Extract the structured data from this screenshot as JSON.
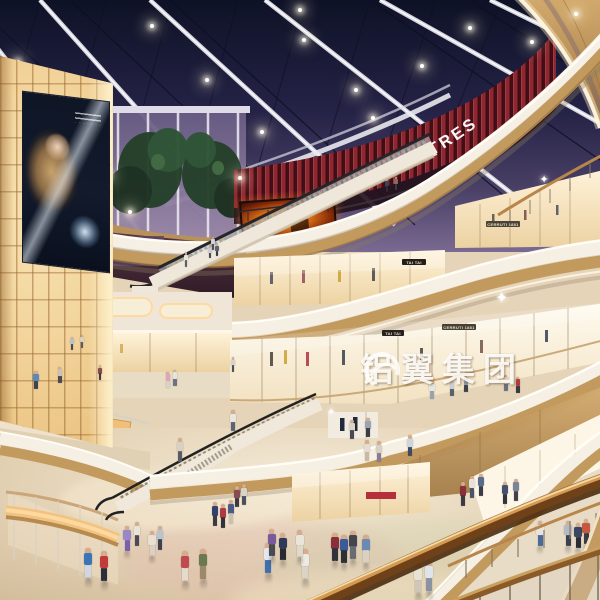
{
  "scene_label": "shopping mall atrium interior rendering",
  "signs": {
    "theatre": {
      "label": "THEATRES"
    },
    "watermark": {
      "label": "铝翼集团"
    },
    "shops": [
      {
        "label": "CERRUTI 1881"
      },
      {
        "label": "TAI TAI"
      },
      {
        "label": "TAI TAI"
      },
      {
        "label": "CERRUTI 1881"
      }
    ]
  },
  "colors": {
    "sky_top": "#0e1226",
    "sky_bottom": "#7a6a92",
    "slat_red": "#b93340",
    "slat_dark": "#4a0f16",
    "amber_wall": "#f3d59d",
    "wood": "#c29a5e",
    "cream_fascia": "#f5efe4",
    "floor": "#e2d0b2",
    "handrail_wood": "#6e4119",
    "fire_billboard": "#f08018"
  },
  "lamps": [
    [
      18,
      62
    ],
    [
      64,
      120
    ],
    [
      108,
      176
    ],
    [
      152,
      26
    ],
    [
      207,
      80
    ],
    [
      262,
      132
    ],
    [
      304,
      40
    ],
    [
      356,
      90
    ],
    [
      300,
      10
    ],
    [
      422,
      66
    ],
    [
      470,
      28
    ],
    [
      532,
      42
    ],
    [
      576,
      14
    ],
    [
      240,
      178
    ],
    [
      130,
      212
    ],
    [
      373,
      118
    ]
  ],
  "sparkles": [
    {
      "x": 503,
      "y": 296,
      "size": 16
    },
    {
      "x": 545,
      "y": 178,
      "size": 11
    },
    {
      "x": 332,
      "y": 412,
      "size": 10
    }
  ],
  "people": [
    {
      "x": 88,
      "y": 578,
      "s": 1,
      "t": "#3a76b5",
      "b": "#cfd8e2"
    },
    {
      "x": 104,
      "y": 581,
      "s": 1,
      "t": "#c23b3b",
      "b": "#2e2e38"
    },
    {
      "x": 127,
      "y": 551,
      "s": 0.85,
      "t": "#9a86c9",
      "b": "#7a5fae"
    },
    {
      "x": 137,
      "y": 546,
      "s": 0.8,
      "t": "#e8e4da",
      "b": "#4a4a52"
    },
    {
      "x": 152,
      "y": 556,
      "s": 0.85,
      "t": "#e8e0d2",
      "b": "#d9d2c4"
    },
    {
      "x": 160,
      "y": 550,
      "s": 0.8,
      "t": "#b8c4d4",
      "b": "#3c4250"
    },
    {
      "x": 185,
      "y": 581,
      "s": 1,
      "t": "#c14a50",
      "b": "#e3dccc"
    },
    {
      "x": 203,
      "y": 579,
      "s": 1,
      "t": "#6a7a4e",
      "b": "#9a8a6a"
    },
    {
      "x": 215,
      "y": 526,
      "s": 0.8,
      "t": "#32406e",
      "b": "#3a3a42"
    },
    {
      "x": 223,
      "y": 528,
      "s": 0.8,
      "t": "#b03a44",
      "b": "#32323a"
    },
    {
      "x": 231,
      "y": 524,
      "s": 0.8,
      "t": "#4a5a80",
      "b": "#c9c2b2"
    },
    {
      "x": 237,
      "y": 507,
      "s": 0.7,
      "t": "#8a4a52",
      "b": "#3a3a42"
    },
    {
      "x": 244,
      "y": 505,
      "s": 0.7,
      "t": "#d9d4c8",
      "b": "#4a5262"
    },
    {
      "x": 268,
      "y": 573,
      "s": 1,
      "t": "#e4e8ee",
      "b": "#3f6fae"
    },
    {
      "x": 305,
      "y": 579,
      "s": 1,
      "t": "#eceae2",
      "b": "#d9d4c6"
    },
    {
      "x": 272,
      "y": 556,
      "s": 0.9,
      "t": "#7a5a9a",
      "b": "#4a4a52"
    },
    {
      "x": 283,
      "y": 560,
      "s": 0.9,
      "t": "#2e3a5a",
      "b": "#2a2a32"
    },
    {
      "x": 300,
      "y": 557,
      "s": 0.9,
      "t": "#e9e5d9",
      "b": "#e0d9c9"
    },
    {
      "x": 335,
      "y": 561,
      "s": 0.95,
      "t": "#8a2e3a",
      "b": "#32323c"
    },
    {
      "x": 344,
      "y": 563,
      "s": 0.95,
      "t": "#3a5a9a",
      "b": "#2e2e36"
    },
    {
      "x": 353,
      "y": 559,
      "s": 0.95,
      "t": "#44444e",
      "b": "#6a6a74"
    },
    {
      "x": 366,
      "y": 563,
      "s": 0.95,
      "t": "#6a8ab4",
      "b": "#d9d2c2"
    },
    {
      "x": 418,
      "y": 593,
      "s": 1,
      "t": "#e8e2d4",
      "b": "#cfc8b8"
    },
    {
      "x": 429,
      "y": 591,
      "s": 1,
      "t": "#dfe4ea",
      "b": "#8a93a4"
    },
    {
      "x": 463,
      "y": 506,
      "s": 0.8,
      "t": "#8a3038",
      "b": "#3a3a44"
    },
    {
      "x": 472,
      "y": 498,
      "s": 0.75,
      "t": "#e6e2d8",
      "b": "#4a5468"
    },
    {
      "x": 481,
      "y": 496,
      "s": 0.75,
      "t": "#5a6a8a",
      "b": "#3c3c46"
    },
    {
      "x": 540,
      "y": 546,
      "s": 0.85,
      "t": "#e8e4dc",
      "b": "#4a6a9a"
    },
    {
      "x": 568,
      "y": 546,
      "s": 0.85,
      "t": "#b4bac4",
      "b": "#3a4050"
    },
    {
      "x": 578,
      "y": 548,
      "s": 0.85,
      "t": "#3a4662",
      "b": "#2c2c34"
    },
    {
      "x": 586,
      "y": 544,
      "s": 0.85,
      "t": "#c9563e",
      "b": "#3a3a42"
    },
    {
      "x": 505,
      "y": 504,
      "s": 0.75,
      "t": "#44506e",
      "b": "#33333b"
    },
    {
      "x": 516,
      "y": 501,
      "s": 0.75,
      "t": "#7a8498",
      "b": "#42424c"
    },
    {
      "x": 233,
      "y": 431,
      "s": 0.7,
      "t": "#e9e6de",
      "b": "#5a6474"
    },
    {
      "x": 180,
      "y": 462,
      "s": 0.8,
      "t": "#d9d0c2",
      "b": "#5a5a64"
    },
    {
      "x": 352,
      "y": 439,
      "s": 0.65,
      "t": "#d9d4c8",
      "b": "#4a4a54"
    },
    {
      "x": 368,
      "y": 437,
      "s": 0.65,
      "t": "#9aa4b4",
      "b": "#3c3c46"
    },
    {
      "x": 367,
      "y": 461,
      "s": 0.7,
      "t": "#e4ddd0",
      "b": "#c9b8a4"
    },
    {
      "x": 379,
      "y": 462,
      "s": 0.7,
      "t": "#d9cfc2",
      "b": "#8a7a9a"
    },
    {
      "x": 410,
      "y": 456,
      "s": 0.7,
      "t": "#cfd4dc",
      "b": "#3f4a60"
    },
    {
      "x": 432,
      "y": 399,
      "s": 0.6,
      "t": "#e9e6df",
      "b": "#9aa2ae"
    },
    {
      "x": 452,
      "y": 396,
      "s": 0.55,
      "t": "#c9cdd6",
      "b": "#5a5f6c"
    },
    {
      "x": 466,
      "y": 392,
      "s": 0.55,
      "t": "#8a93a2",
      "b": "#3d424e"
    },
    {
      "x": 506,
      "y": 391,
      "s": 0.55,
      "t": "#d9d5cc",
      "b": "#6a7080"
    },
    {
      "x": 518,
      "y": 393,
      "s": 0.55,
      "t": "#b43a42",
      "b": "#3a3a44"
    },
    {
      "x": 36,
      "y": 389,
      "s": 0.6,
      "t": "#5a89b8",
      "b": "#3c4252"
    },
    {
      "x": 60,
      "y": 383,
      "s": 0.55,
      "t": "#c9c2b4",
      "b": "#4a4a54"
    },
    {
      "x": 100,
      "y": 380,
      "s": 0.5,
      "t": "#8a4a4a",
      "b": "#3a3a42"
    },
    {
      "x": 168,
      "y": 388,
      "s": 0.55,
      "t": "#e2a4b8",
      "b": "#d9d2c4"
    },
    {
      "x": 175,
      "y": 386,
      "s": 0.55,
      "t": "#e8e4da",
      "b": "#6a7284"
    },
    {
      "x": 233,
      "y": 372,
      "s": 0.5,
      "t": "#d9d4ca",
      "b": "#4a4f5c"
    },
    {
      "x": 72,
      "y": 350,
      "s": 0.45,
      "t": "#b8c2d0",
      "b": "#4a4a52"
    },
    {
      "x": 82,
      "y": 348,
      "s": 0.45,
      "t": "#d9d0c0",
      "b": "#5a5a64"
    },
    {
      "x": 387,
      "y": 192,
      "s": 0.45,
      "t": "#3a4258",
      "b": "#2c2c34"
    },
    {
      "x": 396,
      "y": 190,
      "s": 0.45,
      "t": "#8a6a5a",
      "b": "#3a3a42"
    },
    {
      "x": 210,
      "y": 258,
      "s": 0.4,
      "t": "#c9ccd4",
      "b": "#4a4a54"
    },
    {
      "x": 217,
      "y": 256,
      "s": 0.4,
      "t": "#5a6478",
      "b": "#3a3a44"
    },
    {
      "x": 186,
      "y": 267,
      "s": 0.5,
      "t": "#e8e5de",
      "b": "#5a5f6a"
    },
    {
      "x": 213,
      "y": 250,
      "s": 0.45,
      "t": "#cfd2d8",
      "b": "#4a4e5a"
    }
  ]
}
